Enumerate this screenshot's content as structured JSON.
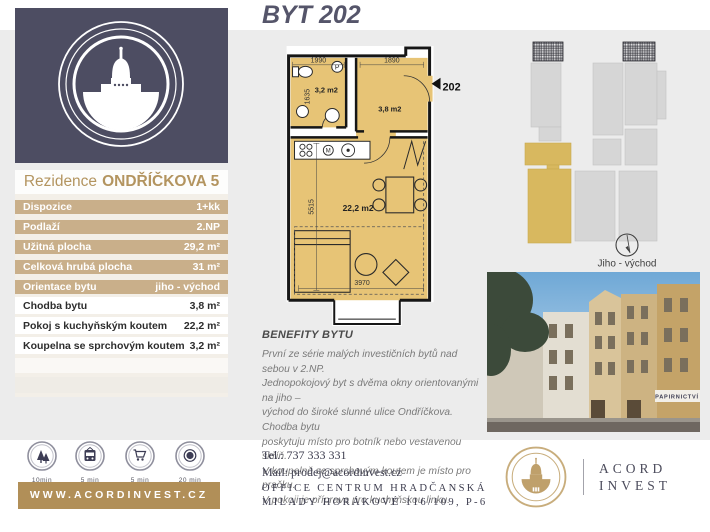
{
  "page": {
    "title": "BYT 202"
  },
  "residence": {
    "title_regular": "Rezidence",
    "title_bold": "ONDŘÍČKOVA 5",
    "rows": [
      {
        "label": "Dispozice",
        "value": "1+kk"
      },
      {
        "label": "Podlaží",
        "value": "2.NP"
      },
      {
        "label": "Užitná plocha",
        "value": "29,2 m²"
      },
      {
        "label": "Celková hrubá plocha",
        "value": "31 m²"
      },
      {
        "label": "Orientace bytu",
        "value": "jiho - východ"
      }
    ],
    "details": [
      {
        "label": "Chodba bytu",
        "value": "3,8 m²"
      },
      {
        "label": "Pokoj s kuchyňským koutem",
        "value": "22,2 m²"
      },
      {
        "label": "Koupelna se sprchovým koutem",
        "value": "3,2 m²"
      }
    ]
  },
  "floorplan": {
    "dims": {
      "bath_width": "1990",
      "bath_depth": "1635",
      "hall_width": "1890",
      "room_depth": "5515",
      "room_width": "3970"
    },
    "areas": {
      "bathroom": "3,2 m2",
      "hall": "3,8 m2",
      "room": "22,2 m2"
    },
    "unit_number": "202",
    "washer_symbol": "P",
    "microwave_symbol": "M"
  },
  "siteplan": {
    "orientation_label": "Jiho - východ"
  },
  "benefits": {
    "heading": "BENEFITY BYTU",
    "text": "První ze série malých investičních bytů nad sebou v 2.NP.\nJednopokojový byt s dvěma okny orientovanými na jiho –\nvýchod do široké slunné ulice Ondříčkova. Chodba bytu\nposkytuju místo pro botník nebo vestavenou skříň.\nV koupelně se sprchovým koutem je místo pro pračku.\nV pokoji je příprava pro kuchyňskou linku."
  },
  "poi": {
    "items": [
      {
        "icon": "trees-icon",
        "label": "10min"
      },
      {
        "icon": "tram-icon",
        "label": "5 min"
      },
      {
        "icon": "cart-icon",
        "label": "5 min"
      },
      {
        "icon": "metro-icon",
        "label": "20 min"
      }
    ]
  },
  "website": {
    "label": "WWW.ACORDINVEST.CZ"
  },
  "contact": {
    "tel": "Tel.: 737 333 331",
    "mail": "Mail: prodej@acordinvest.cz",
    "address1": "OFFICE CENTRUM HRADČANSKÁ",
    "address2": "MILADY HORÁKOVÉ 116/109, P-6"
  },
  "brand": {
    "line1": "ACORD",
    "line2": "INVEST"
  },
  "photo": {
    "sign_text": "PAPIRNICTVÍ"
  },
  "colors": {
    "navy": "#4d4d62",
    "tan_row": "#c9af8a",
    "gold_bar": "#b18f58",
    "plan_gold": "#e7c476",
    "highlight_gold": "#d8b85f",
    "band_gray": "#ececec"
  }
}
